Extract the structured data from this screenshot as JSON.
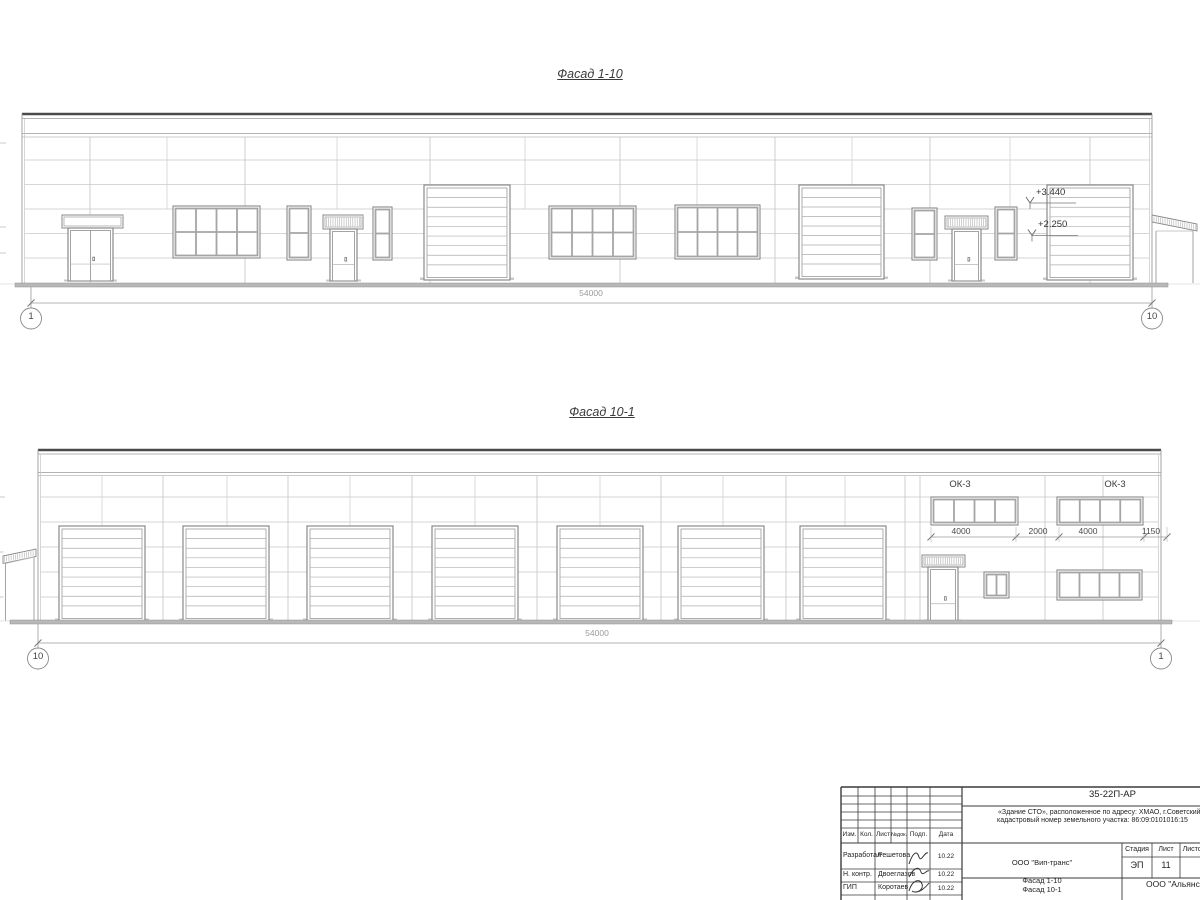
{
  "drawing": {
    "facade_top": {
      "title": "Фасад 1-10",
      "total_dim": "54000",
      "axis_left": "1",
      "axis_right": "10",
      "elev_upper": "+3.440",
      "elev_lower": "+2.250"
    },
    "facade_bottom": {
      "title": "Фасад 10-1",
      "total_dim": "54000",
      "axis_left": "10",
      "axis_right": "1",
      "ok_label_1": "ОК-3",
      "ok_label_2": "ОК-3",
      "dims": [
        "4000",
        "2000",
        "4000",
        "1150"
      ]
    }
  },
  "titleblock": {
    "doc_code": "35-22П-АР",
    "desc_line1": "«Здание СТО», расположенное по адресу: ХМАО, г.Советский,",
    "desc_line2": "кадастровый номер земельного участка: 86:09:0101016:15",
    "cols": [
      "Изм.",
      "Кол.",
      "Лист",
      "№док.",
      "Подп.",
      "Дата"
    ],
    "rows": [
      {
        "role": "Разработал",
        "name": "Решетова",
        "date": "10.22"
      },
      {
        "role": "Н. контр.",
        "name": "Двоеглазов",
        "date": "10.22"
      },
      {
        "role": "ГИП",
        "name": "Коротаев",
        "date": "10.22"
      }
    ],
    "org_middle": "ООО \"Вип-транс\"",
    "stage_label": "Стадия",
    "sheet_label": "Лист",
    "sheets_label": "Листов",
    "stage_value": "ЭП",
    "sheet_value": "11",
    "subject_line1": "Фасад 1-10",
    "subject_line2": "Фасад 10-1",
    "org_right": "ООО \"Альянс\""
  }
}
